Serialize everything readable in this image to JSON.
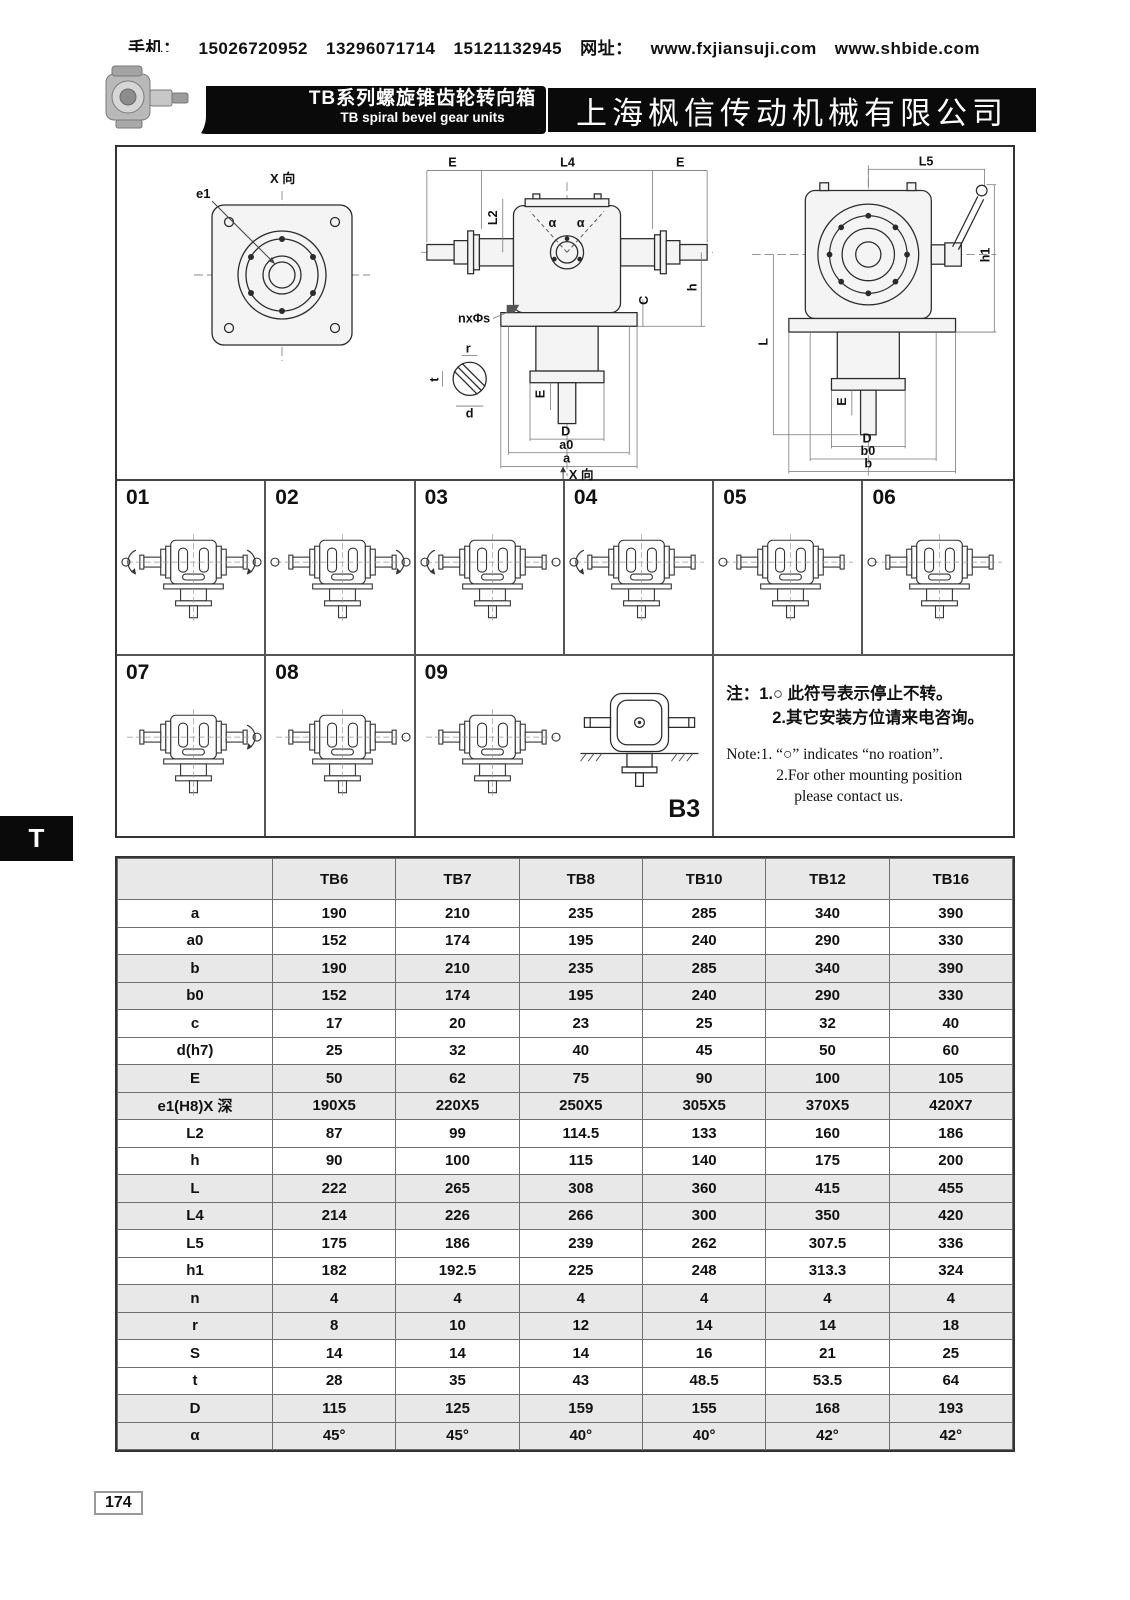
{
  "header": {
    "phone_label": "手机：",
    "phone1": "15026720952",
    "phone2": "13296071714",
    "phone3": "15121132945",
    "web_label": "网址：",
    "web1": "www.fxjiansuji.com",
    "web2": "www.shbide.com"
  },
  "banner": {
    "series_zh": "TB系列螺旋锥齿轮转向箱",
    "series_en": "TB spiral bevel gear units",
    "company": "上海枫信传动机械有限公司"
  },
  "drawing": {
    "view_label": "X 向",
    "view_label_bottom": "X 向",
    "e1": "e1",
    "E": "E",
    "L4": "L4",
    "L2": "L2",
    "alpha": "α",
    "C": "C",
    "h": "h",
    "nxs": "nxΦs",
    "r": "r",
    "t": "t",
    "d": "d",
    "D": "D",
    "a0": "a0",
    "a": "a",
    "L5": "L5",
    "h1": "h1",
    "L": "L",
    "b0": "b0",
    "b": "b"
  },
  "positions": {
    "items": [
      "01",
      "02",
      "03",
      "04",
      "05",
      "06",
      "07",
      "08",
      "09"
    ],
    "b3": "B3",
    "note_zh1": "注：1.○ 此符号表示停止不转。",
    "note_zh2": "2.其它安装方位请来电咨询。",
    "note_en1": "Note:1. “○” indicates “no roation”.",
    "note_en2": "2.For other mounting position",
    "note_en3": "please contact us."
  },
  "side_tab": "T",
  "page_number": "174",
  "table": {
    "corner": "",
    "columns": [
      "TB6",
      "TB7",
      "TB8",
      "TB10",
      "TB12",
      "TB16"
    ],
    "rows": [
      {
        "label": "a",
        "values": [
          "190",
          "210",
          "235",
          "285",
          "340",
          "390"
        ]
      },
      {
        "label": "a0",
        "values": [
          "152",
          "174",
          "195",
          "240",
          "290",
          "330"
        ]
      },
      {
        "label": "b",
        "values": [
          "190",
          "210",
          "235",
          "285",
          "340",
          "390"
        ]
      },
      {
        "label": "b0",
        "values": [
          "152",
          "174",
          "195",
          "240",
          "290",
          "330"
        ]
      },
      {
        "label": "c",
        "values": [
          "17",
          "20",
          "23",
          "25",
          "32",
          "40"
        ]
      },
      {
        "label": "d(h7)",
        "values": [
          "25",
          "32",
          "40",
          "45",
          "50",
          "60"
        ]
      },
      {
        "label": "E",
        "values": [
          "50",
          "62",
          "75",
          "90",
          "100",
          "105"
        ]
      },
      {
        "label": "e1(H8)X 深",
        "values": [
          "190X5",
          "220X5",
          "250X5",
          "305X5",
          "370X5",
          "420X7"
        ]
      },
      {
        "label": "L2",
        "values": [
          "87",
          "99",
          "114.5",
          "133",
          "160",
          "186"
        ]
      },
      {
        "label": "h",
        "values": [
          "90",
          "100",
          "115",
          "140",
          "175",
          "200"
        ]
      },
      {
        "label": "L",
        "values": [
          "222",
          "265",
          "308",
          "360",
          "415",
          "455"
        ]
      },
      {
        "label": "L4",
        "values": [
          "214",
          "226",
          "266",
          "300",
          "350",
          "420"
        ]
      },
      {
        "label": "L5",
        "values": [
          "175",
          "186",
          "239",
          "262",
          "307.5",
          "336"
        ]
      },
      {
        "label": "h1",
        "values": [
          "182",
          "192.5",
          "225",
          "248",
          "313.3",
          "324"
        ]
      },
      {
        "label": "n",
        "values": [
          "4",
          "4",
          "4",
          "4",
          "4",
          "4"
        ]
      },
      {
        "label": "r",
        "values": [
          "8",
          "10",
          "12",
          "14",
          "14",
          "18"
        ]
      },
      {
        "label": "S",
        "values": [
          "14",
          "14",
          "14",
          "16",
          "21",
          "25"
        ]
      },
      {
        "label": "t",
        "values": [
          "28",
          "35",
          "43",
          "48.5",
          "53.5",
          "64"
        ]
      },
      {
        "label": "D",
        "values": [
          "115",
          "125",
          "159",
          "155",
          "168",
          "193"
        ]
      },
      {
        "label": "α",
        "values": [
          "45°",
          "45°",
          "40°",
          "40°",
          "42°",
          "42°"
        ]
      }
    ]
  }
}
